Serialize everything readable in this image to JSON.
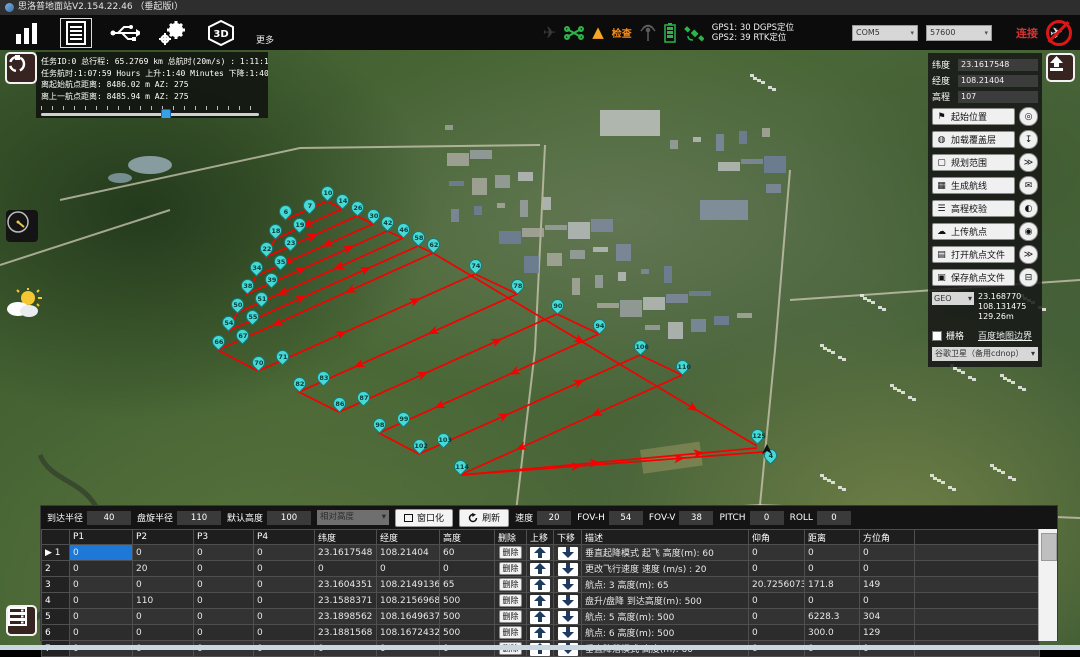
{
  "title_bar": {
    "title": "思洛普地面站V2.154.22.46 （垂起版Ⅰ）"
  },
  "toolbar": {
    "more_label": "更多",
    "check_label": "检查",
    "gps_line1": "GPS1: 30 DGPS定位",
    "gps_line2": "GPS2: 39 RTK定位",
    "com_port": "COM5",
    "baud_rate": "57600",
    "connect_label": "连接",
    "icons": [
      "signal-bars",
      "flight-log",
      "usb",
      "settings-gears",
      "3d-view"
    ],
    "status_icons": [
      "airplane",
      "drone",
      "warning",
      "antenna",
      "battery",
      "satellite"
    ]
  },
  "mission_info": {
    "line1": "任务ID:0 总行程: 65.2769 km 总航时(20m/s) : 1:11:19",
    "line2": "任务航时:1:07:59 Hours 上升:1:40 Minutes 下降:1:40 Minutes",
    "line3": "离起始航点距离: 8486.02 m AZ: 275",
    "line4": "离上一航点距离: 8485.94 m AZ: 275",
    "slider_percent": 56
  },
  "right_panel": {
    "lat_label": "纬度",
    "lat": "23.1617548",
    "lon_label": "经度",
    "lon": "108.21404",
    "alt_label": "高程",
    "alt": "107",
    "buttons": [
      {
        "label": "起始位置",
        "icon": "⚑",
        "side": "◎",
        "name": "start-position"
      },
      {
        "label": "加载覆盖层",
        "icon": "◍",
        "side": "↧",
        "name": "load-overlay"
      },
      {
        "label": "规划范围",
        "icon": "▢",
        "side": "≫",
        "name": "plan-area"
      },
      {
        "label": "生成航线",
        "icon": "▦",
        "side": "✉",
        "name": "generate-route"
      },
      {
        "label": "高程校验",
        "icon": "☰",
        "side": "◐",
        "name": "elevation-check"
      },
      {
        "label": "上传航点",
        "icon": "☁",
        "side": "◉",
        "name": "upload-waypoints"
      },
      {
        "label": "打开航点文件",
        "icon": "▤",
        "side": "≫",
        "name": "open-waypoint-file"
      },
      {
        "label": "保存航点文件",
        "icon": "▣",
        "side": "⊟",
        "name": "save-waypoint-file"
      }
    ],
    "geo_select": "GEO",
    "geo_lat": "23.168770",
    "geo_lon": "108.131475",
    "geo_alt": "129.26m",
    "grid_label": "栅格",
    "baidu_link": "百度地图边界",
    "map_source": "谷歌卫星（备用cdnop）"
  },
  "bottom_toolbar": {
    "fields1": [
      {
        "label": "到达半径",
        "value": "40"
      },
      {
        "label": "盘旋半径",
        "value": "110"
      },
      {
        "label": "默认高度",
        "value": "100"
      }
    ],
    "height_mode": "相对高度",
    "window_btn": "窗口化",
    "refresh_btn": "刷新",
    "fields2": [
      {
        "label": "速度",
        "value": "20"
      },
      {
        "label": "FOV-H",
        "value": "54"
      },
      {
        "label": "FOV-V",
        "value": "38"
      },
      {
        "label": "PITCH",
        "value": "0"
      },
      {
        "label": "ROLL",
        "value": "0"
      }
    ]
  },
  "table": {
    "headers": [
      "",
      "P1",
      "P2",
      "P3",
      "P4",
      "纬度",
      "经度",
      "高度",
      "删除",
      "上移",
      "下移",
      "描述",
      "仰角",
      "距离",
      "方位角",
      ""
    ],
    "delete_label": "删除",
    "rows": [
      {
        "num": "1",
        "p1": "0",
        "p2": "0",
        "p3": "0",
        "p4": "0",
        "lat": "23.1617548",
        "lon": "108.21404",
        "alt": "60",
        "desc": "垂直起降模式 起飞 高度(m): 60",
        "pitch": "0",
        "dist": "0",
        "az": "0",
        "selected": true
      },
      {
        "num": "2",
        "p1": "0",
        "p2": "20",
        "p3": "0",
        "p4": "0",
        "lat": "0",
        "lon": "0",
        "alt": "0",
        "desc": "更改飞行速度 速度 (m/s) : 20",
        "pitch": "0",
        "dist": "0",
        "az": "0"
      },
      {
        "num": "3",
        "p1": "0",
        "p2": "0",
        "p3": "0",
        "p4": "0",
        "lat": "23.1604351",
        "lon": "108.2149136",
        "alt": "65",
        "desc": "航点: 3  高度(m): 65",
        "pitch": "20.725607374379",
        "dist": "171.8",
        "az": "149"
      },
      {
        "num": "4",
        "p1": "0",
        "p2": "110",
        "p3": "0",
        "p4": "0",
        "lat": "23.1588371",
        "lon": "108.2156968",
        "alt": "500",
        "desc": "盘升/盘降  到达高度(m): 500",
        "pitch": "0",
        "dist": "0",
        "az": "0"
      },
      {
        "num": "5",
        "p1": "0",
        "p2": "0",
        "p3": "0",
        "p4": "0",
        "lat": "23.1898562",
        "lon": "108.1649637",
        "alt": "500",
        "desc": "航点: 5  高度(m): 500",
        "pitch": "0",
        "dist": "6228.3",
        "az": "304"
      },
      {
        "num": "6",
        "p1": "0",
        "p2": "0",
        "p3": "0",
        "p4": "0",
        "lat": "23.1881568",
        "lon": "108.1672432",
        "alt": "500",
        "desc": "航点: 6  高度(m): 500",
        "pitch": "0",
        "dist": "300.0",
        "az": "129"
      },
      {
        "num": "7",
        "p1": "0",
        "p2": "0",
        "p3": "0",
        "p4": "0",
        "lat": "0",
        "lon": "0",
        "alt": "0",
        "desc": "垂直降落模式 高度(m): 60",
        "pitch": "0",
        "dist": "0",
        "az": "0"
      }
    ]
  },
  "map": {
    "line_color": "#f40000",
    "marker_fill": "#49d9d5",
    "markers": [
      {
        "n": "6",
        "x": 285,
        "y": 170,
        "s": "v"
      },
      {
        "n": "7",
        "x": 309,
        "y": 164,
        "s": "c"
      },
      {
        "n": "10",
        "x": 327,
        "y": 151,
        "s": "v"
      },
      {
        "n": "14",
        "x": 342,
        "y": 159,
        "s": "v"
      },
      {
        "n": "18",
        "x": 275,
        "y": 189,
        "s": "v"
      },
      {
        "n": "19",
        "x": 299,
        "y": 183,
        "s": "c"
      },
      {
        "n": "22",
        "x": 266,
        "y": 207,
        "s": "v"
      },
      {
        "n": "23",
        "x": 290,
        "y": 201,
        "s": "c"
      },
      {
        "n": "26",
        "x": 357,
        "y": 166,
        "s": "v"
      },
      {
        "n": "30",
        "x": 373,
        "y": 174,
        "s": "v"
      },
      {
        "n": "34",
        "x": 256,
        "y": 226,
        "s": "v"
      },
      {
        "n": "35",
        "x": 280,
        "y": 220,
        "s": "c"
      },
      {
        "n": "38",
        "x": 247,
        "y": 244,
        "s": "v"
      },
      {
        "n": "39",
        "x": 271,
        "y": 238,
        "s": "c"
      },
      {
        "n": "42",
        "x": 387,
        "y": 181,
        "s": "v"
      },
      {
        "n": "46",
        "x": 403,
        "y": 188,
        "s": "v"
      },
      {
        "n": "50",
        "x": 237,
        "y": 263,
        "s": "v"
      },
      {
        "n": "51",
        "x": 261,
        "y": 257,
        "s": "c"
      },
      {
        "n": "54",
        "x": 228,
        "y": 281,
        "s": "v"
      },
      {
        "n": "55",
        "x": 252,
        "y": 275,
        "s": "c"
      },
      {
        "n": "58",
        "x": 418,
        "y": 196,
        "s": "v"
      },
      {
        "n": "62",
        "x": 433,
        "y": 203,
        "s": "v"
      },
      {
        "n": "66",
        "x": 218,
        "y": 300,
        "s": "v"
      },
      {
        "n": "67",
        "x": 242,
        "y": 294,
        "s": "c"
      },
      {
        "n": "70",
        "x": 258,
        "y": 321,
        "s": "v"
      },
      {
        "n": "71",
        "x": 282,
        "y": 315,
        "s": "c"
      },
      {
        "n": "74",
        "x": 475,
        "y": 224,
        "s": "v"
      },
      {
        "n": "78",
        "x": 517,
        "y": 244,
        "s": "v"
      },
      {
        "n": "82",
        "x": 299,
        "y": 342,
        "s": "v"
      },
      {
        "n": "83",
        "x": 323,
        "y": 336,
        "s": "c"
      },
      {
        "n": "86",
        "x": 339,
        "y": 362,
        "s": "v"
      },
      {
        "n": "87",
        "x": 363,
        "y": 356,
        "s": "c"
      },
      {
        "n": "90",
        "x": 557,
        "y": 264,
        "s": "v"
      },
      {
        "n": "94",
        "x": 599,
        "y": 284,
        "s": "v"
      },
      {
        "n": "98",
        "x": 379,
        "y": 383,
        "s": "v"
      },
      {
        "n": "99",
        "x": 403,
        "y": 377,
        "s": "c"
      },
      {
        "n": "102",
        "x": 419,
        "y": 404,
        "s": "v"
      },
      {
        "n": "103",
        "x": 443,
        "y": 398,
        "s": "c"
      },
      {
        "n": "106",
        "x": 640,
        "y": 305,
        "s": "v"
      },
      {
        "n": "110",
        "x": 682,
        "y": 325,
        "s": "v"
      },
      {
        "n": "114",
        "x": 460,
        "y": 425,
        "s": "v"
      },
      {
        "n": "125",
        "x": 757,
        "y": 394,
        "s": "x"
      },
      {
        "n": "4",
        "x": 770,
        "y": 414,
        "s": "x"
      }
    ],
    "home_point": {
      "x": 763,
      "y": 402
    }
  }
}
